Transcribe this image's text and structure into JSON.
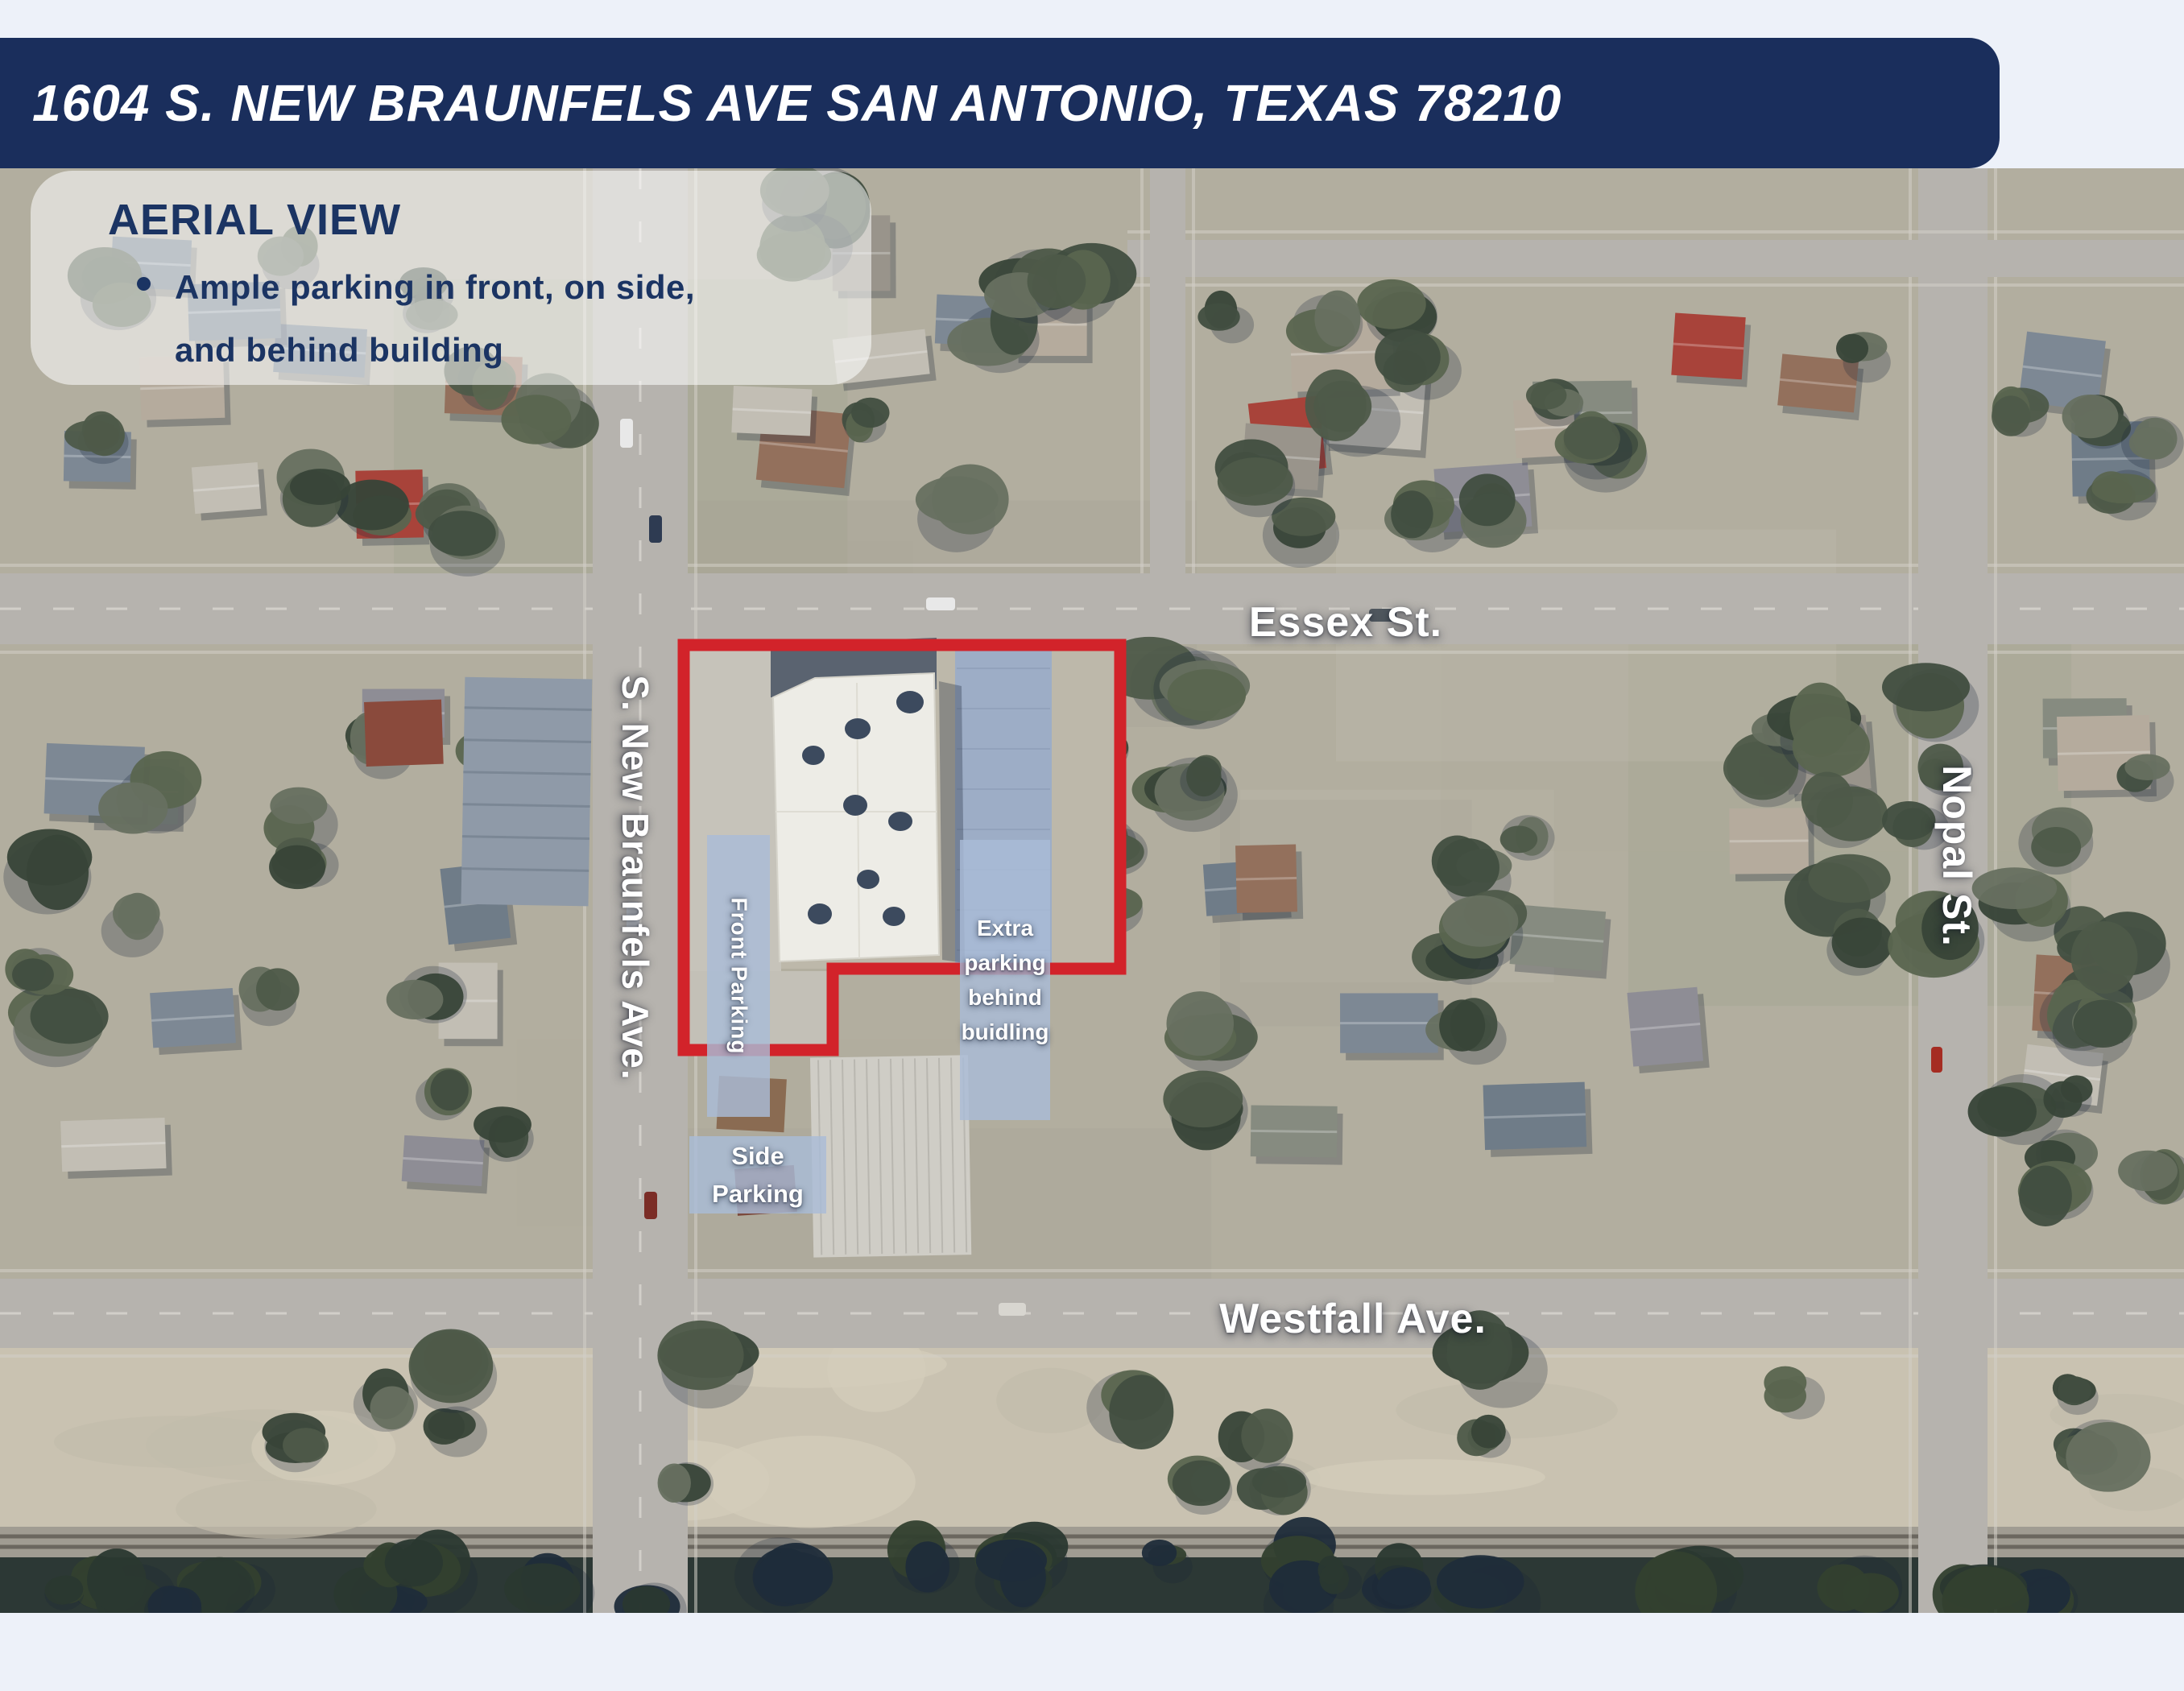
{
  "page_background": "#EDF1F9",
  "banner": {
    "address": "1604 S. NEW BRAUNFELS AVE SAN ANTONIO, TEXAS 78210",
    "bg_color": "#1A2E5C",
    "text_color": "#FFFFFF"
  },
  "callout": {
    "title": "AERIAL VIEW",
    "bullet_lines": [
      "Ample parking in front, on side,",
      "and behind building"
    ],
    "text_color": "#1B3463"
  },
  "map": {
    "streets": {
      "essex": "Essex St.",
      "nopal": "Nopal St.",
      "new_braunfels": "S. New Braunfels Ave.",
      "westfall": "Westfall Ave."
    },
    "property": {
      "outline_color": "#D2232A",
      "front_label": "Front Parking",
      "extra_label_lines": [
        "Extra",
        "parking",
        "behind",
        "buidling"
      ],
      "side_label_lines": [
        "Side",
        "Parking"
      ]
    }
  }
}
